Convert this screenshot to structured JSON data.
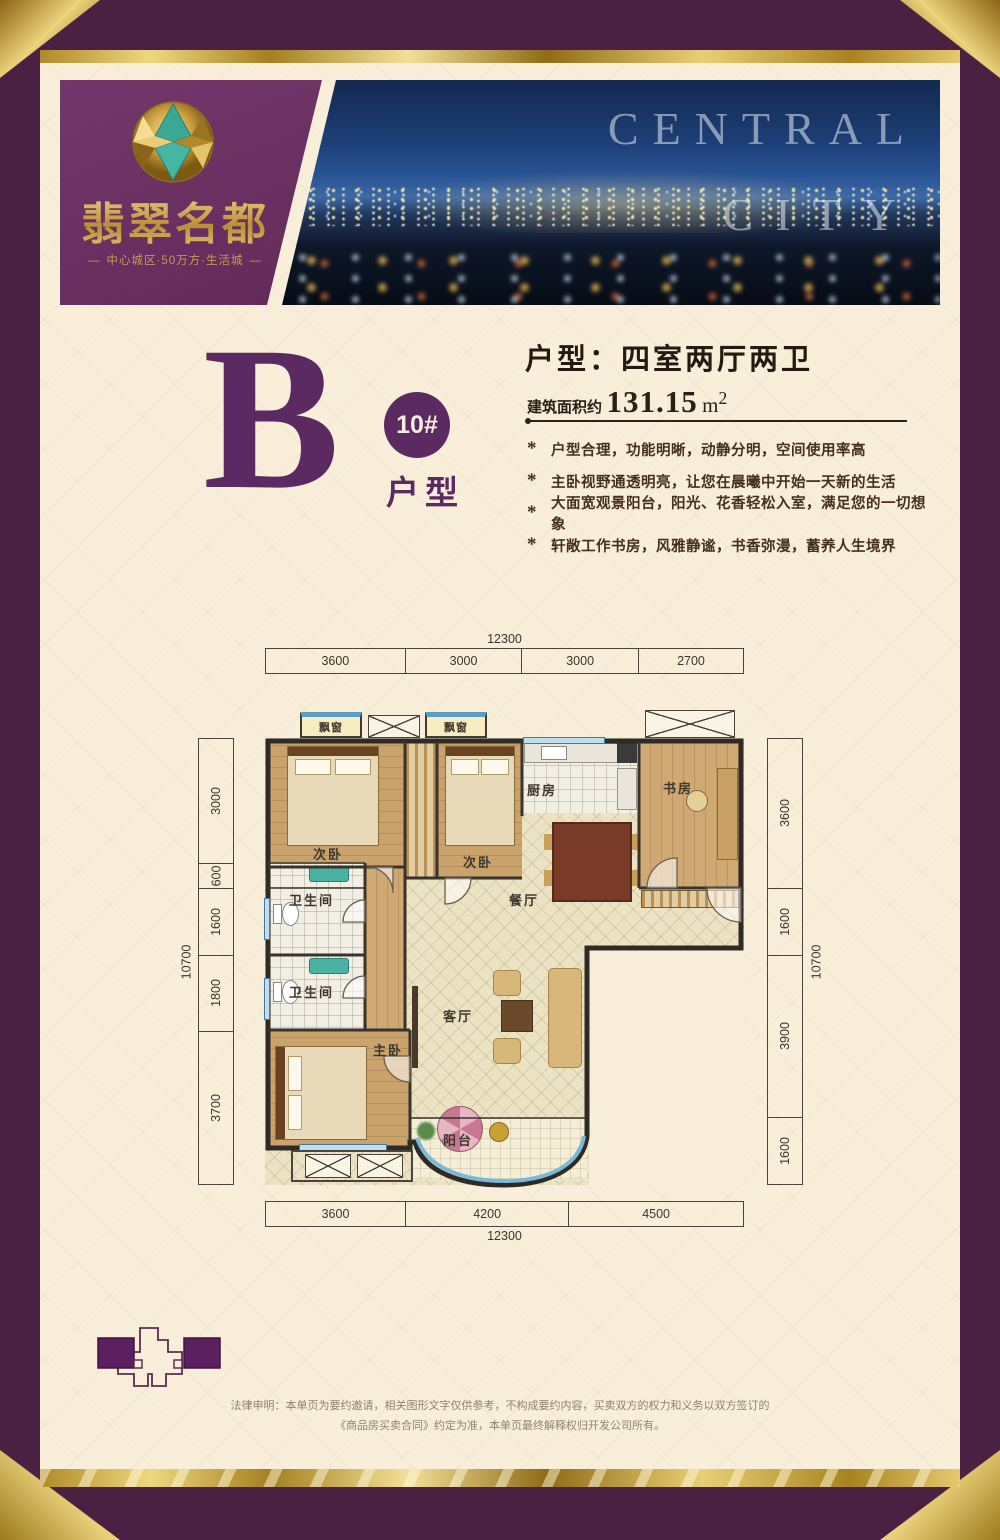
{
  "brand": {
    "name": "翡翠名都",
    "tagline": "中心城区·50万方·生活城",
    "photo_word_1": "CENTRAL",
    "photo_word_2": "CITY"
  },
  "unit": {
    "letter": "B",
    "badge": "10#",
    "type_label": "户型",
    "title": "户型：四室两厅两卫",
    "area_label": "建筑面积约",
    "area_value": "131.15",
    "area_unit_base": "m",
    "area_unit_sup": "2"
  },
  "features": {
    "bullet": "*",
    "items": [
      "户型合理，功能明晰，动静分明，空间使用率高",
      "主卧视野通透明亮，让您在晨曦中开始一天新的生活",
      "大面宽观景阳台，阳光、花香轻松入室，满足您的一切想象",
      "轩敞工作书房，风雅静谧，书香弥漫，蓄养人生境界"
    ]
  },
  "plan": {
    "rooms": {
      "bedroom_a": "次卧",
      "bedroom_b": "次卧",
      "kitchen": "厨房",
      "study": "书房",
      "bath_1": "卫生间",
      "bath_2": "卫生间",
      "dining": "餐厅",
      "living": "客厅",
      "master": "主卧",
      "balcony": "阳台",
      "bay_window_1": "飘窗",
      "bay_window_2": "飘窗"
    },
    "dims": {
      "top_total": "12300",
      "top": [
        "3600",
        "3000",
        "3000",
        "2700"
      ],
      "bottom": [
        "3600",
        "4200",
        "4500"
      ],
      "bottom_total": "12300",
      "left": [
        "3000",
        "600",
        "1600",
        "1800",
        "3700"
      ],
      "left_total": "10700",
      "right": [
        "3600",
        "1600",
        "3900",
        "1600"
      ],
      "right_total": "10700"
    }
  },
  "legal": {
    "line1": "法律申明：本单页为要约邀请，相关图形文字仅供参考，不构成要约内容，买卖双方的权力和义务以双方签订的",
    "line2": "《商品房买卖合同》约定为准，本单页最终解释权归开发公司所有。"
  },
  "colors": {
    "frame_purple": "#4a2142",
    "panel_purple": "#6b2f63",
    "accent_purple": "#5c2a62",
    "gold": "#caa24e",
    "cream": "#f8eed9",
    "window_blue": "#5b9ec4"
  }
}
